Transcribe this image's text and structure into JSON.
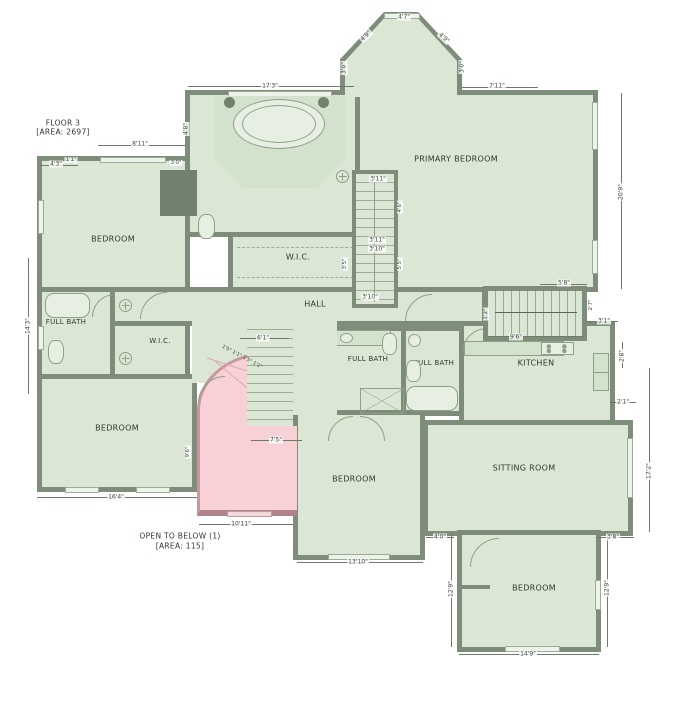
{
  "plan": {
    "floor_label": "FLOOR 3",
    "floor_area": "[AREA: 2697]",
    "open_below_label": "OPEN TO BELOW (1)",
    "open_below_area": "[AREA: 115]"
  },
  "rooms": {
    "bedroom_tl": "BEDROOM",
    "full_bath_top": "FULL BATH",
    "primary_bedroom": "PRIMARY BEDROOM",
    "wic_center": "W.I.C.",
    "hall": "HALL",
    "full_bath_left": "FULL BATH",
    "wic_left": "W.I.C.",
    "bedroom_left": "BEDROOM",
    "full_bath_c1": "FULL BATH",
    "full_bath_c2": "FULL BATH",
    "kitchen": "KITCHEN",
    "sitting_room": "SITTING ROOM",
    "bedroom_bottom": "BEDROOM",
    "bedroom_br": "BEDROOM"
  },
  "dims": {
    "bay_top": "4'7\"",
    "bay_diag_left": "4'9\"",
    "bay_diag_right": "4'9\"",
    "bay_side_left": "3'0\"",
    "bay_side_right": "3'0\"",
    "bath_top_width": "17'3\"",
    "primary_top": "7'11\"",
    "primary_right": "20'9\"",
    "bedtl_top": "8'11\"",
    "bedtl_left": "4'3\"",
    "bedtl_small_a": "1'1\"",
    "bedtl_small_b": "3'0\"",
    "bathtop_left": "4'8\"",
    "outer_left": "14'3\"",
    "stair_top": "3'11\"",
    "stair_mid_a": "3'11\"",
    "stair_mid_b": "3'10\"",
    "stair_bottom": "3'10\"",
    "stair_left_v": "3'5\"",
    "stair_right_v1": "4'6\"",
    "stair_right_v2": "5'5\"",
    "kstair_top": "5'8\"",
    "kstair_bottom": "9'6\"",
    "kstair_left_v": "1'2\"",
    "kstair_right_v": "2'7\"",
    "kitchen_step_a": "3'1\"",
    "kitchen_right_v": "2'8\"",
    "kitchen_step_b": "2'1\"",
    "open_top": "6'1\"",
    "open_stair_w": "7'5\"",
    "open_bottom": "10'11\"",
    "open_left_v": "9'6\"",
    "winder_text": "1'5\" 1'1\" 1'5\" 1'1\"",
    "bedll_bottom": "16'4\"",
    "bedbc_bottom": "13'10\"",
    "bedbc_right_a": "4'0\"",
    "sitting_bottom_b": "3'8\"",
    "sitting_right": "17'2\"",
    "bedbr_left": "12'9\"",
    "bedbr_right": "12'9\"",
    "bedbr_bottom": "14'9\""
  },
  "colors": {
    "wall": "#7e8d79",
    "room_fill": "#dbe7d4",
    "open_fill": "#f7d1d5",
    "open_wall": "#b0838a",
    "dim_text": "#3c473c"
  }
}
